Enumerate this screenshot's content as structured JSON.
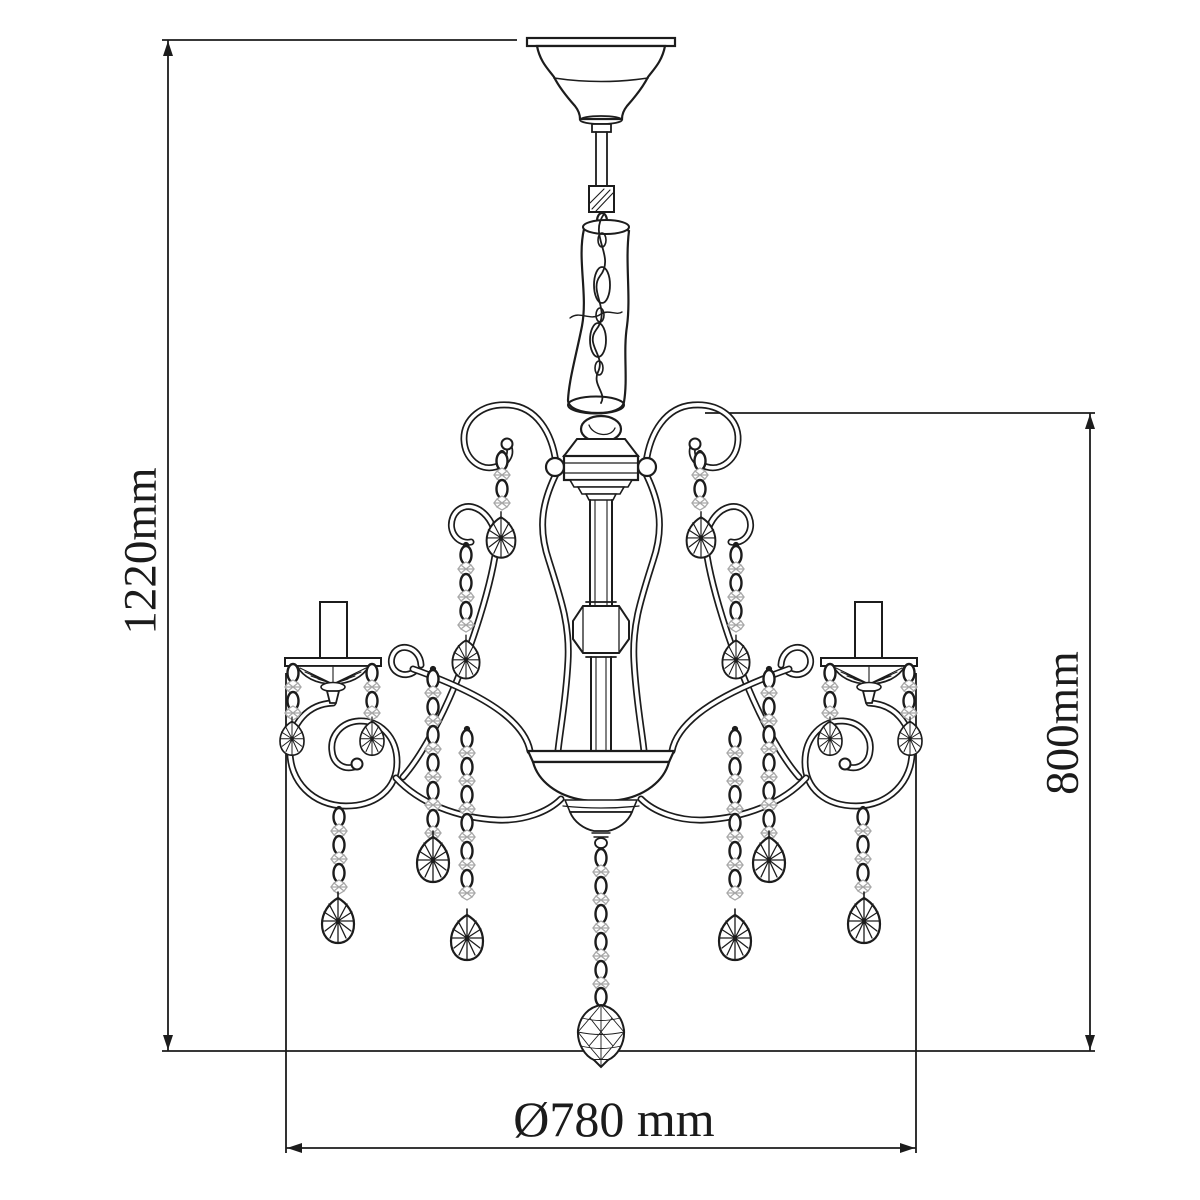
{
  "figure": {
    "background": "#ffffff",
    "line_color": "#1c1c1c",
    "bead_color": "#a8a8a8",
    "subject": "chandelier-technical-line-drawing"
  },
  "dimensions": {
    "overall_height": {
      "label": "1220mm",
      "orientation": "vertical"
    },
    "body_height": {
      "label": "800mm",
      "orientation": "vertical"
    },
    "diameter": {
      "label": "Ø780 mm",
      "orientation": "horizontal"
    }
  }
}
